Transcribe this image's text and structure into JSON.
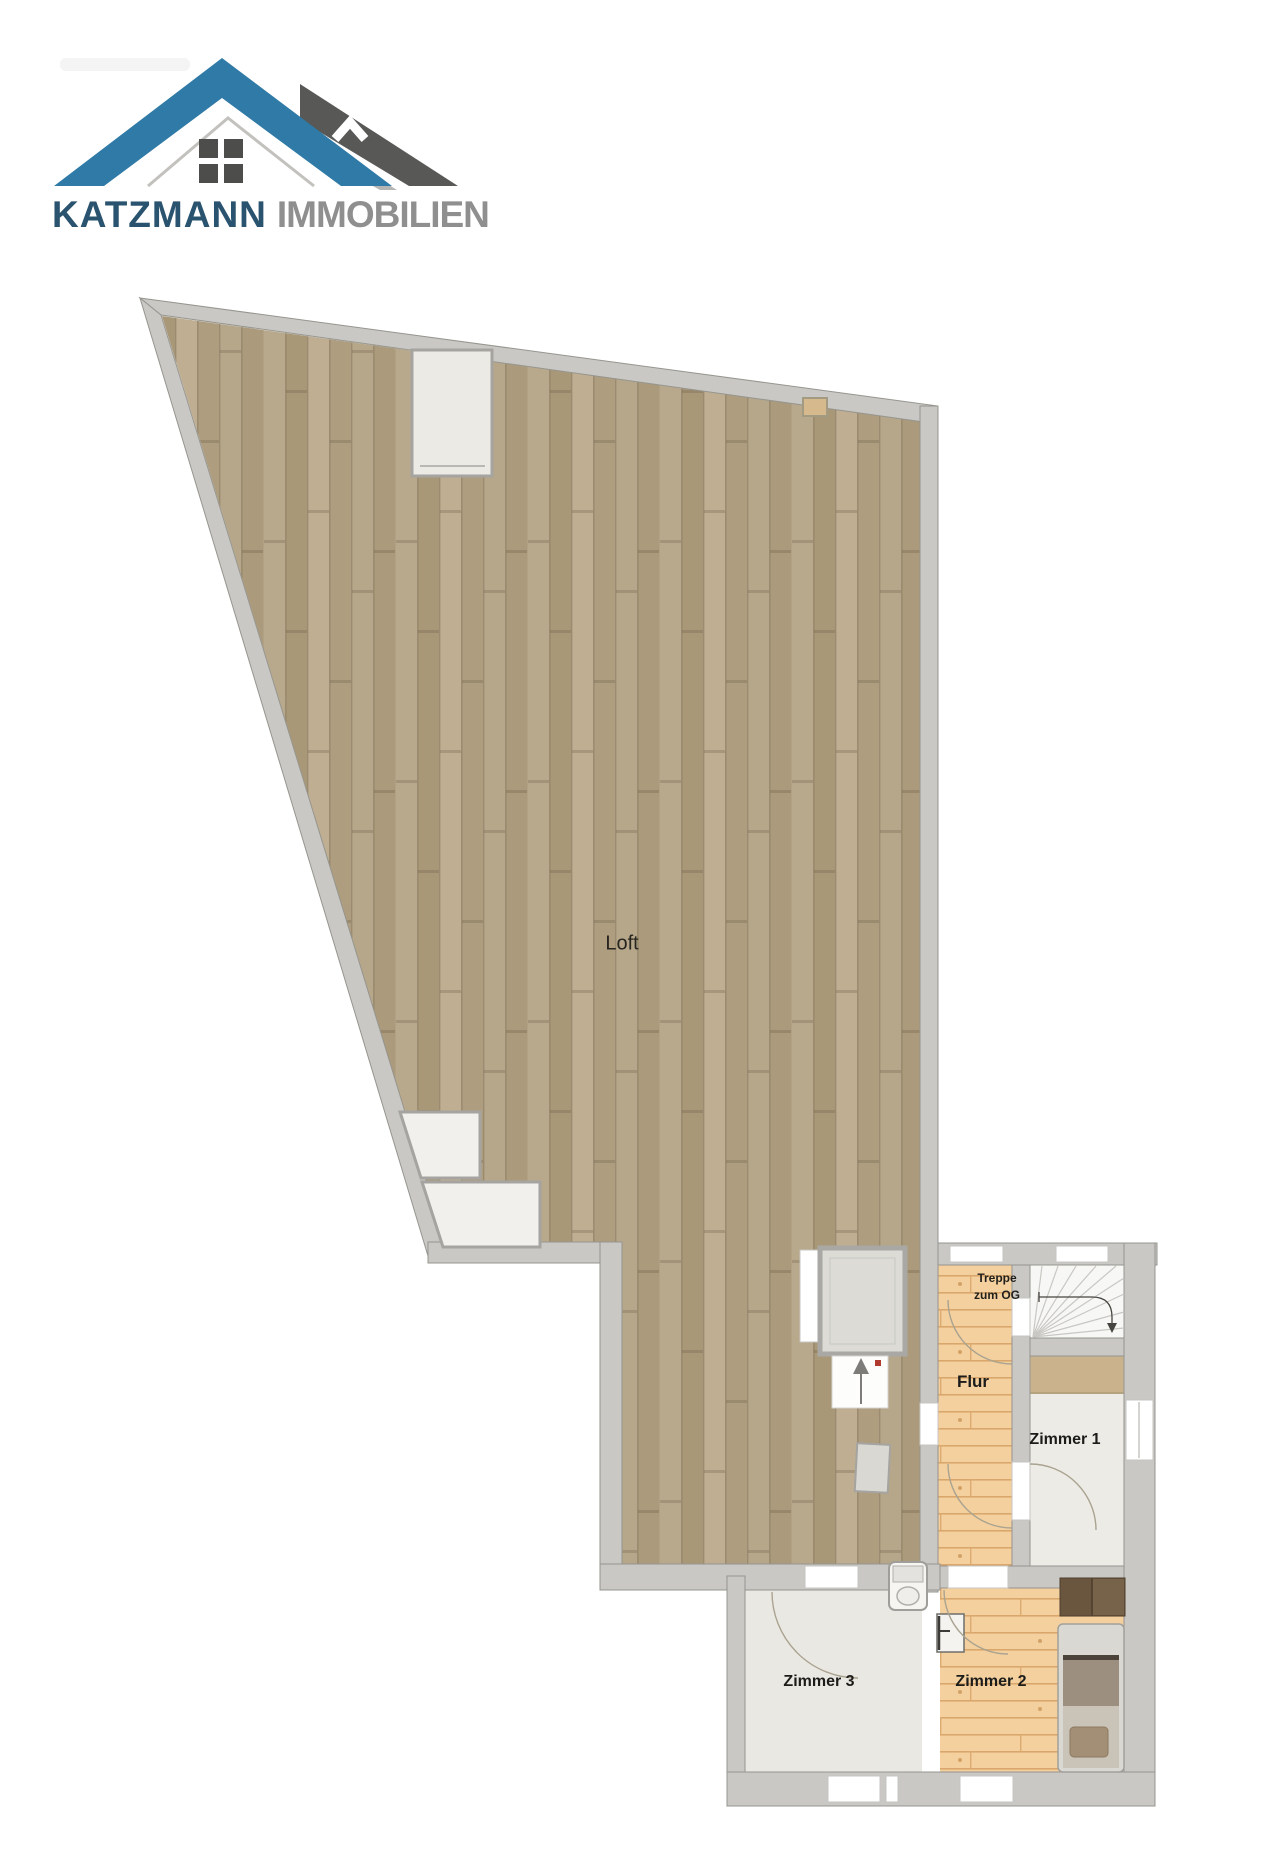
{
  "page": {
    "background": "#ffffff",
    "kind": "real estate floor plan"
  },
  "logo": {
    "brand": "KATZMANN",
    "suffix": "IMMOBILIEN",
    "icon": "double-house-roof-with-window",
    "colors": {
      "roof_blue": "#2f7aa6",
      "roof_dark": "#585856",
      "brand_text": "#29536e",
      "suffix_text": "#8f8f8f",
      "window_panes": "#4d4d4b"
    }
  },
  "floorplan": {
    "rooms": [
      {
        "id": "loft",
        "label": "Loft"
      },
      {
        "id": "flur",
        "label": "Flur"
      },
      {
        "id": "zimmer1",
        "label": "Zimmer 1"
      },
      {
        "id": "zimmer2",
        "label": "Zimmer 2"
      },
      {
        "id": "zimmer3",
        "label": "Zimmer 3"
      }
    ],
    "annotations": [
      {
        "id": "treppe",
        "line1": "Treppe",
        "line2": "zum OG"
      }
    ],
    "colors": {
      "wall": "#c9c8c4",
      "wall_edge": "#96958f",
      "loft_parquet": "#b2a285",
      "pine_floor": "#f4d09e",
      "room_floor_light": "#edebe6",
      "zimmer3_floor": "#eae8e3",
      "stair_floor": "#f7f7f5",
      "tan_band": "#c9b28c",
      "wardrobe_brown": "#6a563f",
      "bed_frame": "#dad8d3",
      "bed_blanket": "#9c8f80",
      "bed_pillow": "#a28f75",
      "accent_red": "#b03a2e"
    }
  }
}
